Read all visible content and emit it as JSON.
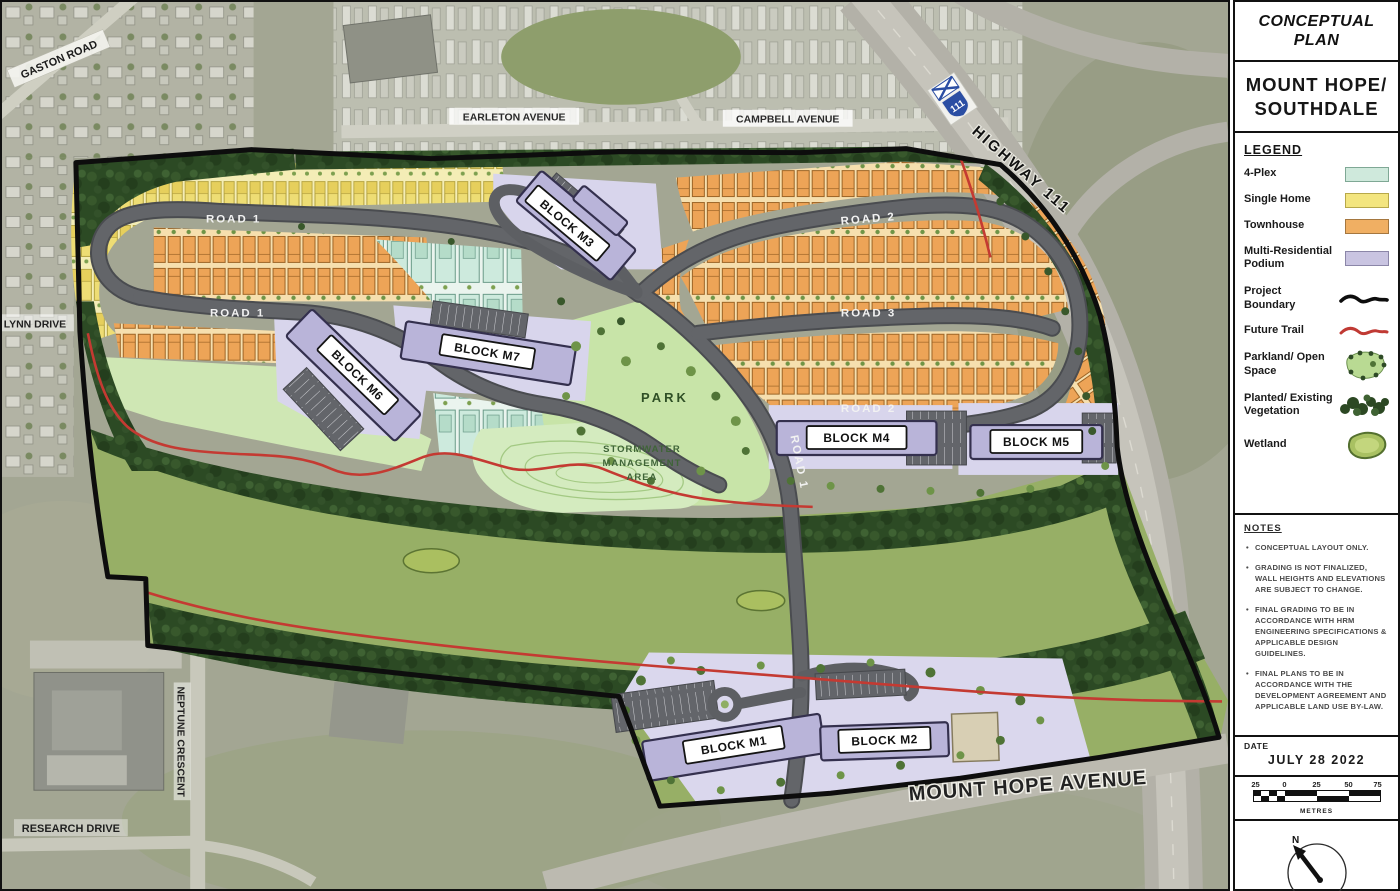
{
  "panel": {
    "plan_type": "CONCEPTUAL PLAN",
    "project_name": "MOUNT HOPE/ SOUTHDALE",
    "legend": {
      "title": "LEGEND",
      "items": [
        {
          "label": "4-Plex",
          "color": "#cfe9dc"
        },
        {
          "label": "Single Home",
          "color": "#f3e57f"
        },
        {
          "label": "Townhouse",
          "color": "#f0af63"
        },
        {
          "label": "Multi-Residential Podium",
          "color": "#c9c4e1"
        },
        {
          "label": "Project Boundary",
          "color": "#0d0d0d"
        },
        {
          "label": "Future Trail",
          "color": "#c03a34"
        },
        {
          "label": "Parkland/ Open Space",
          "color": "#b9da93"
        },
        {
          "label": "Planted/ Existing Vegetation",
          "color": "#2c4823"
        },
        {
          "label": "Wetland",
          "color": "#a9c162"
        }
      ]
    },
    "notes": {
      "title": "NOTES",
      "items": [
        "CONCEPTUAL LAYOUT ONLY.",
        "GRADING IS NOT FINALIZED, WALL HEIGHTS AND ELEVATIONS ARE SUBJECT TO CHANGE.",
        "FINAL GRADING TO BE IN ACCORDANCE WITH HRM ENGINEERING SPECIFICATIONS & APPLICABLE DESIGN GUIDELINES.",
        "FINAL PLANS TO BE IN ACCORDANCE WITH THE DEVELOPMENT AGREEMENT AND APPLICABLE LAND USE BY-LAW."
      ]
    },
    "date": {
      "label": "DATE",
      "value": "JULY 28 2022"
    },
    "scale": {
      "ticks": [
        "25",
        "0",
        "25",
        "50",
        "75"
      ],
      "unit": "METRES"
    },
    "north_label": "N"
  },
  "map": {
    "labels": {
      "gaston_road": "GASTON ROAD",
      "earleton_avenue": "EARLETON AVENUE",
      "campbell_avenue": "CAMPBELL AVENUE",
      "highway_111": "HIGHWAY 111",
      "highway_shield": "111",
      "lynn_drive": "LYNN DRIVE",
      "neptune_crescent": "NEPTUNE CRESCENT",
      "research_drive": "RESEARCH DRIVE",
      "mount_hope_avenue": "MOUNT HOPE AVENUE",
      "road_1": "ROAD 1",
      "road_2": "ROAD 2",
      "road_3": "ROAD 3",
      "park": "PARK",
      "swm_1": "STORMWATER",
      "swm_2": "MANAGEMENT",
      "swm_3": "AREA"
    },
    "blocks": {
      "m1": "BLOCK M1",
      "m2": "BLOCK M2",
      "m3": "BLOCK M3",
      "m4": "BLOCK M4",
      "m5": "BLOCK M5",
      "m6": "BLOCK M6",
      "m7": "BLOCK M7"
    },
    "colors": {
      "road": "#5d5f63",
      "meadow": "#97af66",
      "park_green": "#c8e4a8",
      "forest": "#2c4a24",
      "trail": "#c43a32",
      "boundary": "#0d0d0d"
    }
  }
}
